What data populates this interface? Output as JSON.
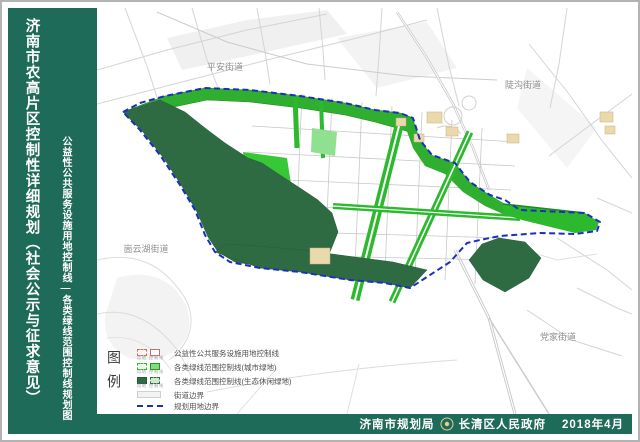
{
  "sidebar": {
    "title": "济南市农高片区控制性详细规划（社会公示与征求意见）",
    "subtitle": "公益性公共服务设施用地控制线—各类绿线范围控制线规划图"
  },
  "map": {
    "street_labels": [
      {
        "text": "平安街道"
      },
      {
        "text": "陡沟街道"
      },
      {
        "text": "崮云湖街道"
      },
      {
        "text": "党家街道"
      }
    ],
    "colors": {
      "banner_teal": "#1f6b5a",
      "urban_green": "#2db92d",
      "eco_green": "#2e6b43",
      "light_green": "#8fe08f",
      "facility_tan": "#ead9ac",
      "boundary_blue": "#1b2fbe",
      "context_road_gray": "#d4d4d4"
    }
  },
  "legend": {
    "title": "图例",
    "swatch_caption": "用地 控制线",
    "items": [
      {
        "label": "公益性公共服务设施用地控制线"
      },
      {
        "label": "各类绿线范围控制线(城市绿地)"
      },
      {
        "label": "各类绿线范围控制线(生态休闲绿地)"
      },
      {
        "label": "街道边界"
      },
      {
        "label": "规划用地边界"
      }
    ]
  },
  "footer": {
    "agency_left": "济南市规划局",
    "agency_right": "长清区人民政府",
    "date": "2018年4月"
  }
}
